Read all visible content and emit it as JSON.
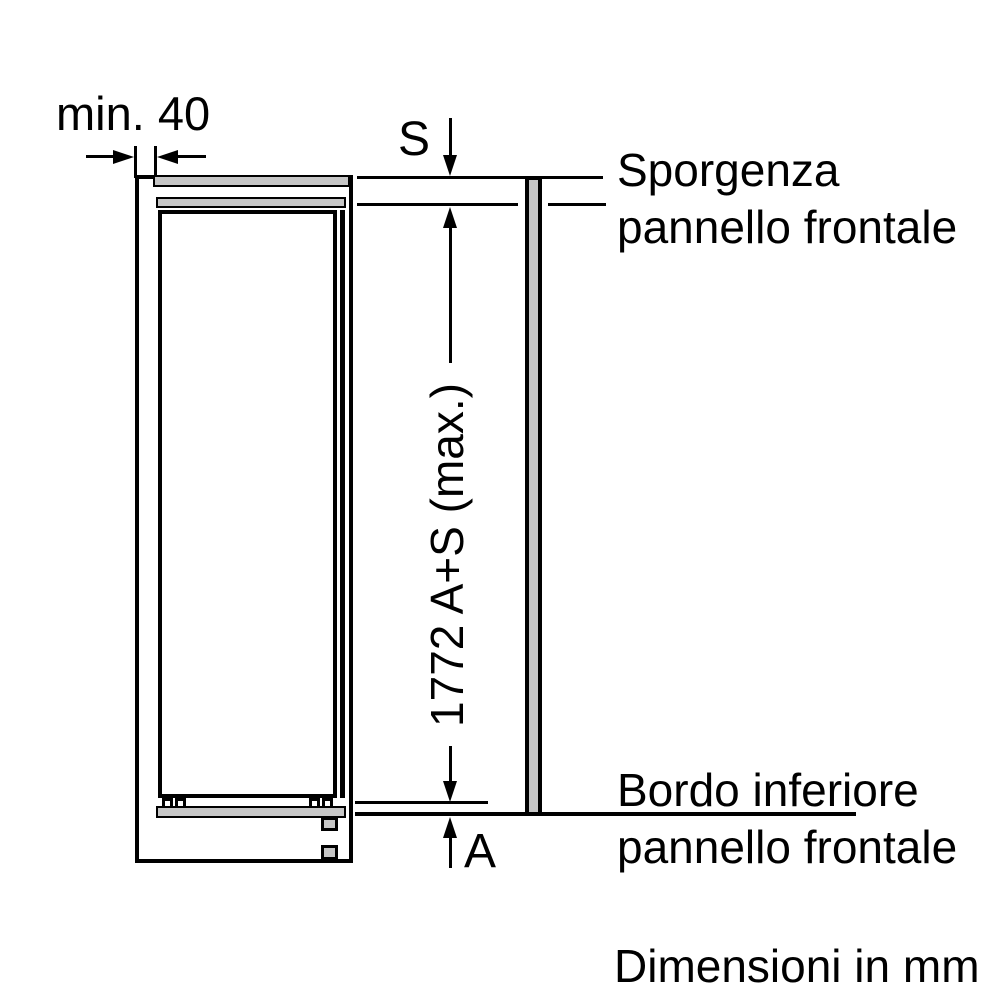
{
  "diagram": {
    "title_note": "Dimensioni in mm",
    "dimensions": {
      "min_gap": "min. 40",
      "top_protrusion": "S",
      "total_height": "1772 A+S (max.)",
      "bottom_distance": "A"
    },
    "labels": {
      "top_panel": {
        "line1": "Sporgenza",
        "line2": "pannello frontale"
      },
      "bottom_panel": {
        "line1": "Bordo inferiore",
        "line2": "pannello frontale"
      }
    },
    "colors": {
      "line": "#000000",
      "fill_gray": "#c6c6c6",
      "background": "#ffffff"
    }
  }
}
